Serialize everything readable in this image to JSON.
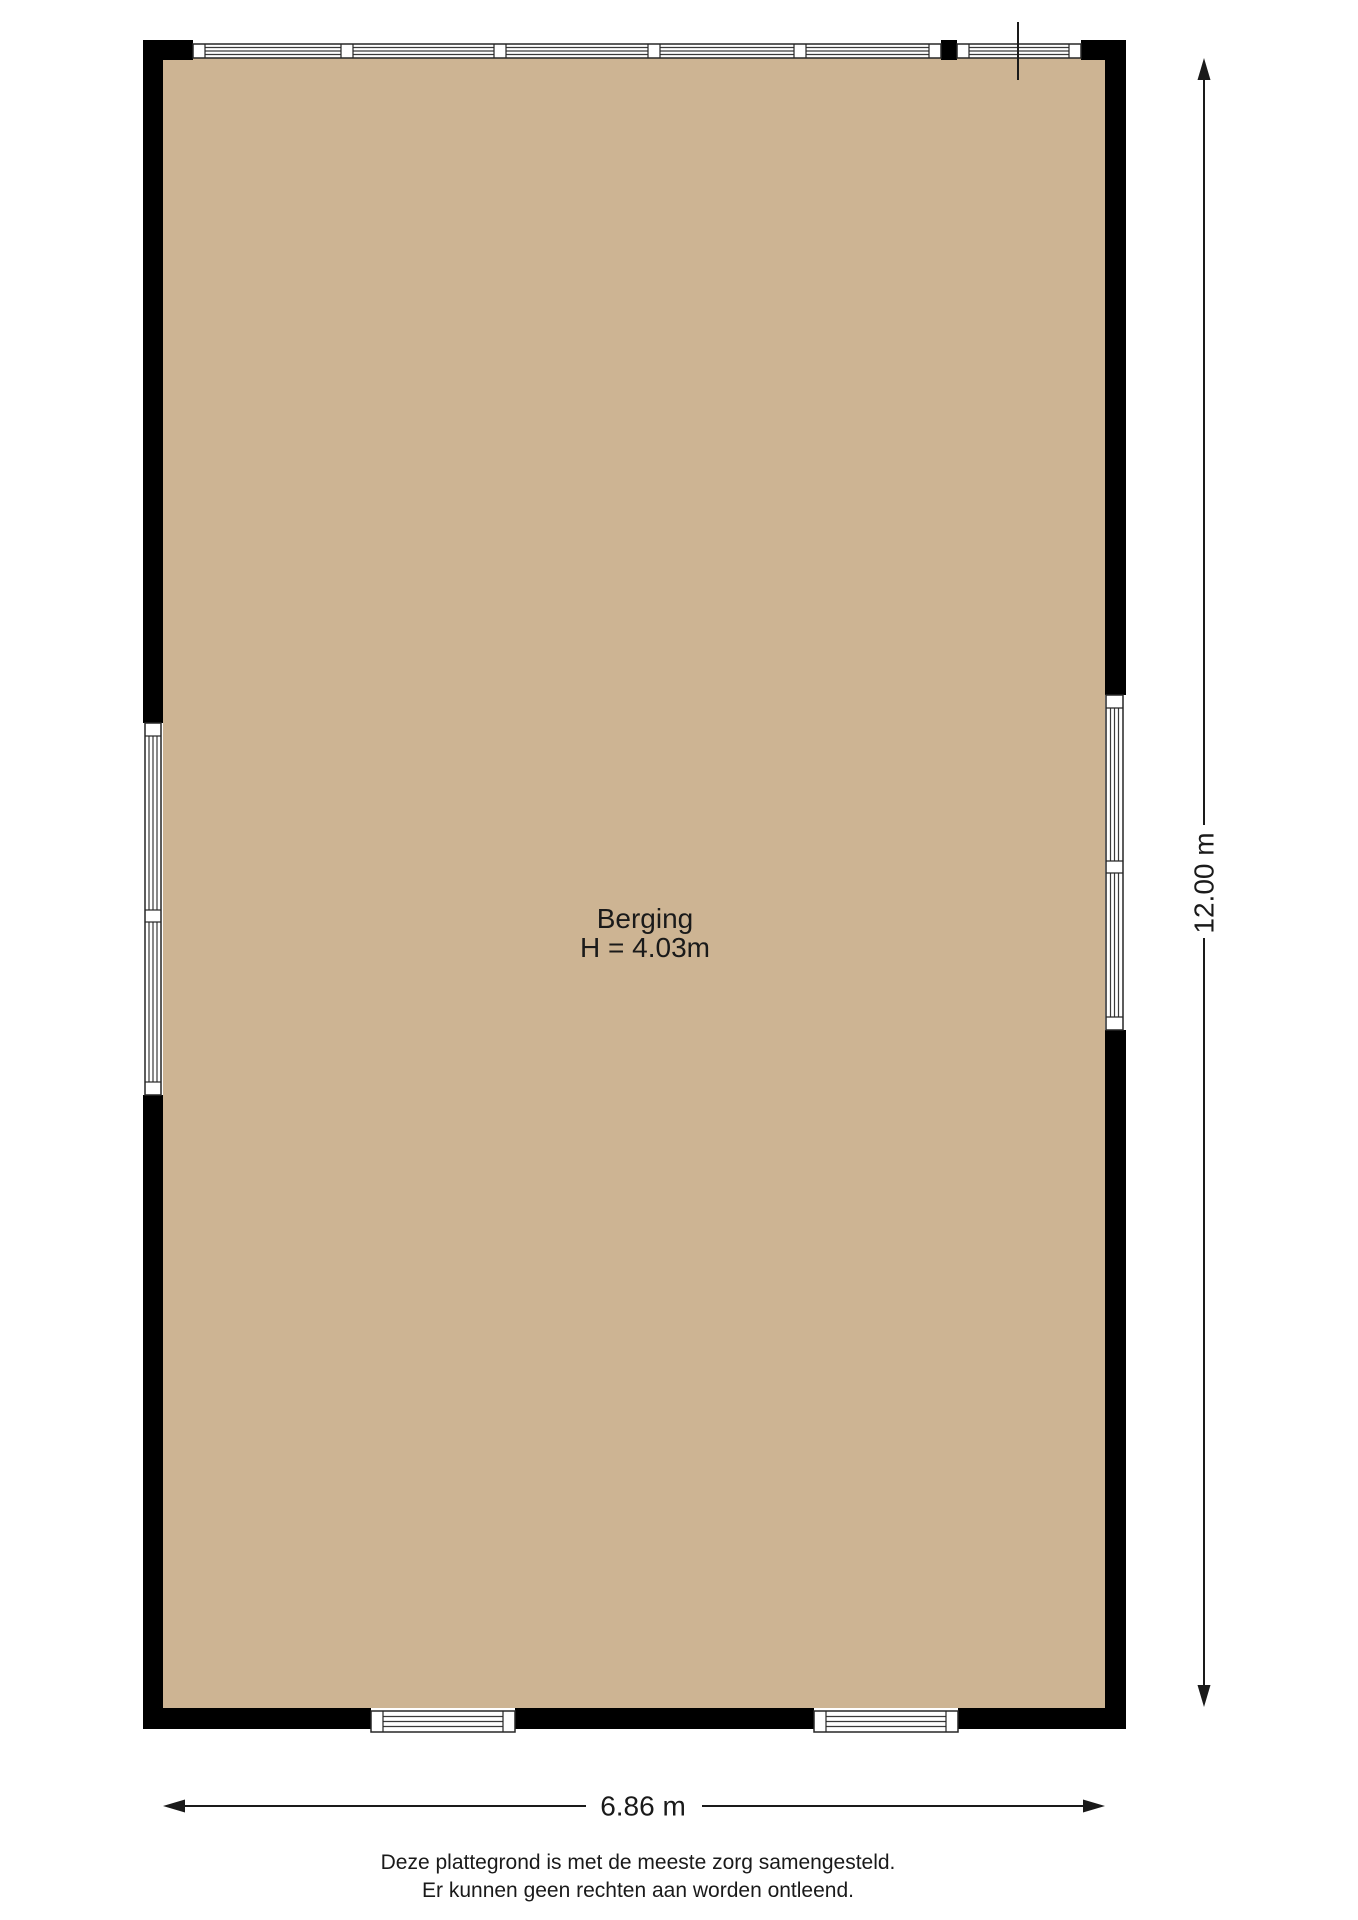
{
  "floorplan": {
    "room": {
      "label": "Berging",
      "ceiling_height": "H = 4.03m"
    },
    "dimensions": {
      "width": "6.86 m",
      "height": "12.00 m"
    },
    "disclaimer": [
      "Deze plattegrond is met de meeste zorg samengesteld.",
      "Er kunnen geen rechten aan worden ontleend."
    ],
    "colors": {
      "floor": "#cdb493",
      "wall": "#000000",
      "window_frame": "#262626",
      "dimension_line": "#1a1a1a"
    }
  }
}
